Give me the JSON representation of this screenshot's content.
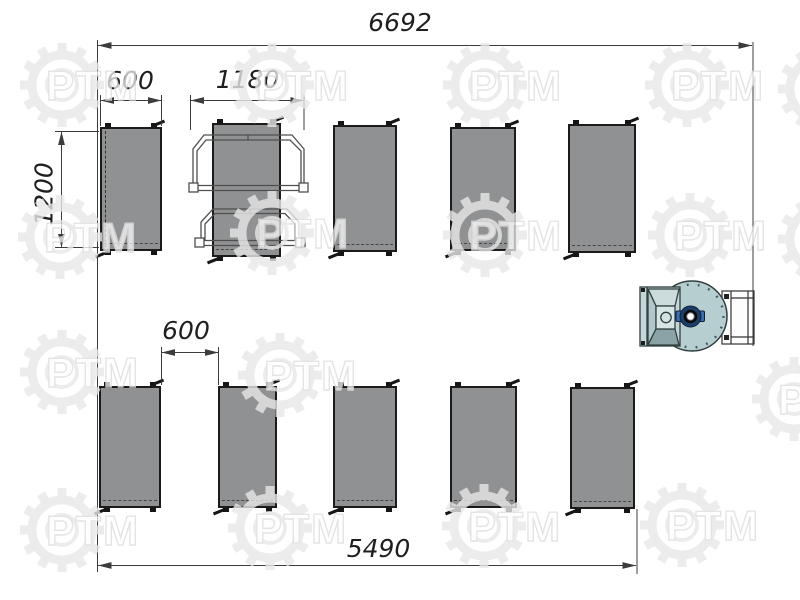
{
  "drawing": {
    "kind": "equipment layout plan",
    "dimensions": {
      "overall_width": "6692",
      "unit_width": "600",
      "trolley_width": "1180",
      "unit_depth": "1200",
      "row_gap": "600",
      "bottom_span": "5490"
    },
    "equipment": {
      "top_row_units": 5,
      "bottom_row_units": 5,
      "has_trolley_frames": true,
      "has_fan_unit": true
    },
    "colors": {
      "unit_fill": "#8f9192",
      "unit_border": "#1b1b1b",
      "fan_body": "#b7ced1",
      "fan_hub_ring": "#1c3e6b",
      "fan_hub_lug": "#3d6fae",
      "dimension_line": "#3c3c3c",
      "watermark": "#e6e6e6"
    }
  },
  "watermark": {
    "text": "РТМ"
  }
}
